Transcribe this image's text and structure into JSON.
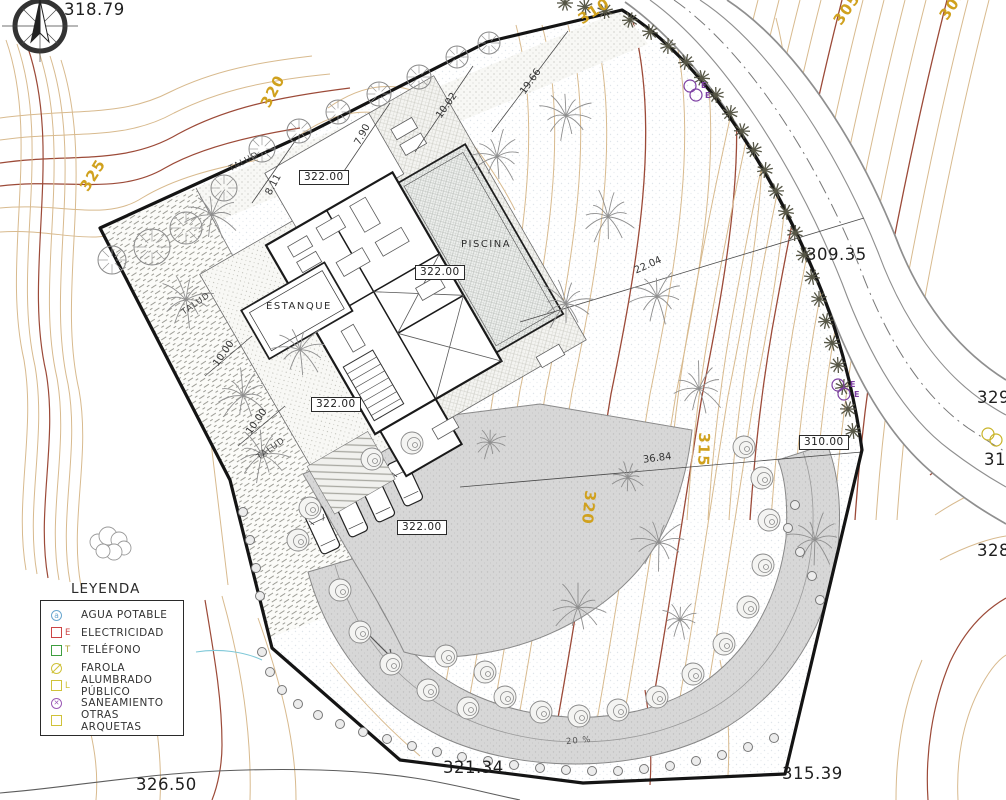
{
  "elevations": {
    "top_left": "318.79",
    "right": "309.35",
    "right_edge_upper": "329.",
    "right_edge_mid": "310",
    "right_edge_lower": "328.",
    "bottom_left": "326.50",
    "bottom_center": "321.34",
    "bottom_right": "315.39"
  },
  "contour_labels": {
    "c320_nw": "320",
    "c325_nw": "325",
    "c310_n": "310",
    "c305_ne": "305",
    "c300_ne": "300",
    "c315_mid": "315",
    "c320_mid": "320"
  },
  "platform_levels": {
    "upper_terrace": "322.00",
    "pool_deck": "322.00",
    "lower_terrace": "322.00",
    "parking": "322.00",
    "road_entry": "310.00"
  },
  "dimensions": {
    "talud_top_a": "8.11",
    "talud_top_b": "7.90",
    "top_a": "10.02",
    "top_b": "19.66",
    "east_a": "22.04",
    "east_b": "36.84",
    "talud_left_a": "10.00",
    "talud_left_b": "10.00"
  },
  "areas": {
    "pool": "PISCINA",
    "pond": "ESTANQUE",
    "slope_top": "TALUD",
    "slope_left": "TALUD",
    "slope_lower": "TALUD"
  },
  "road": {
    "slope_grade": "20 %"
  },
  "utilities": {
    "marker_letter": "E"
  },
  "legend": {
    "title": "LEYENDA",
    "items": [
      {
        "letter": "a",
        "label": "AGUA POTABLE"
      },
      {
        "letter": "E",
        "label": "ELECTRICIDAD"
      },
      {
        "letter": "T",
        "label": "TELÉFONO"
      },
      {
        "letter": "",
        "label": "FAROLA"
      },
      {
        "letter": "L",
        "label": "ALUMBRADO PÚBLICO"
      },
      {
        "letter": "",
        "label": "SANEAMIENTO"
      },
      {
        "letter": "",
        "label": "OTRAS ARQUETAS"
      }
    ]
  },
  "colors": {
    "contour_minor": "#d8ba8e",
    "contour_major": "#9c4a38",
    "contour_label": "#d0a11e",
    "road_gray": "#8f8f8f",
    "boundary": "#141414",
    "utility_purple": "#7d3fa3",
    "utility_yellow": "#c9b428",
    "water_blue": "#7ec8d8"
  }
}
